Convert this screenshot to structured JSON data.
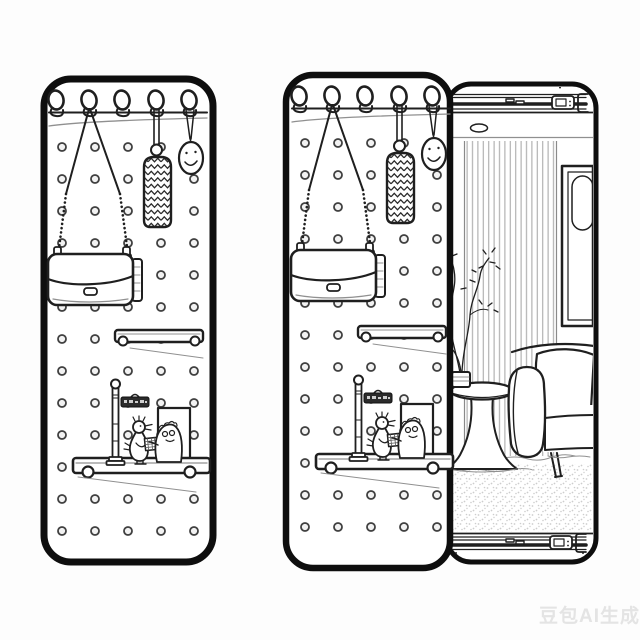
{
  "canvas": {
    "bg": "#fdfdfd",
    "line": "#1f1f1f",
    "border": "#0e0e0e",
    "soft": "#909090",
    "stripe": "#ababab",
    "stipple": "#cdcdcd",
    "hole_fill": "#f2f2f2",
    "sign_fill": "#2b2b2b",
    "watermark": "#e4e4e4"
  },
  "watermark": {
    "text": "豆包AI生成"
  },
  "scene": {
    "style": "black-and-white line-art illustration",
    "panels": {
      "left": "pegboard-door-panel",
      "right": "pegboard-door-panel-sliding-open-over-cabinet"
    },
    "elements": [
      "wall-hook",
      "hook-rail",
      "pegboard-holes",
      "chain-strap-handbag",
      "knitted-chevron-pouch",
      "smiley-egg-charm",
      "floating-shelf",
      "display-shelf",
      "street-lamp",
      "street-sign-illegible",
      "bird-figurine",
      "round-figurine",
      "crosshatch-box",
      "photo-frame",
      "slide-rail-top",
      "slide-rail-bottom",
      "curtain-panel",
      "wall-art-frame",
      "plant-branches",
      "vase",
      "pedestal-side-table",
      "sofa",
      "sofa-cushion",
      "sofa-leg",
      "area-rug"
    ],
    "street_sign_text_legible": false
  }
}
